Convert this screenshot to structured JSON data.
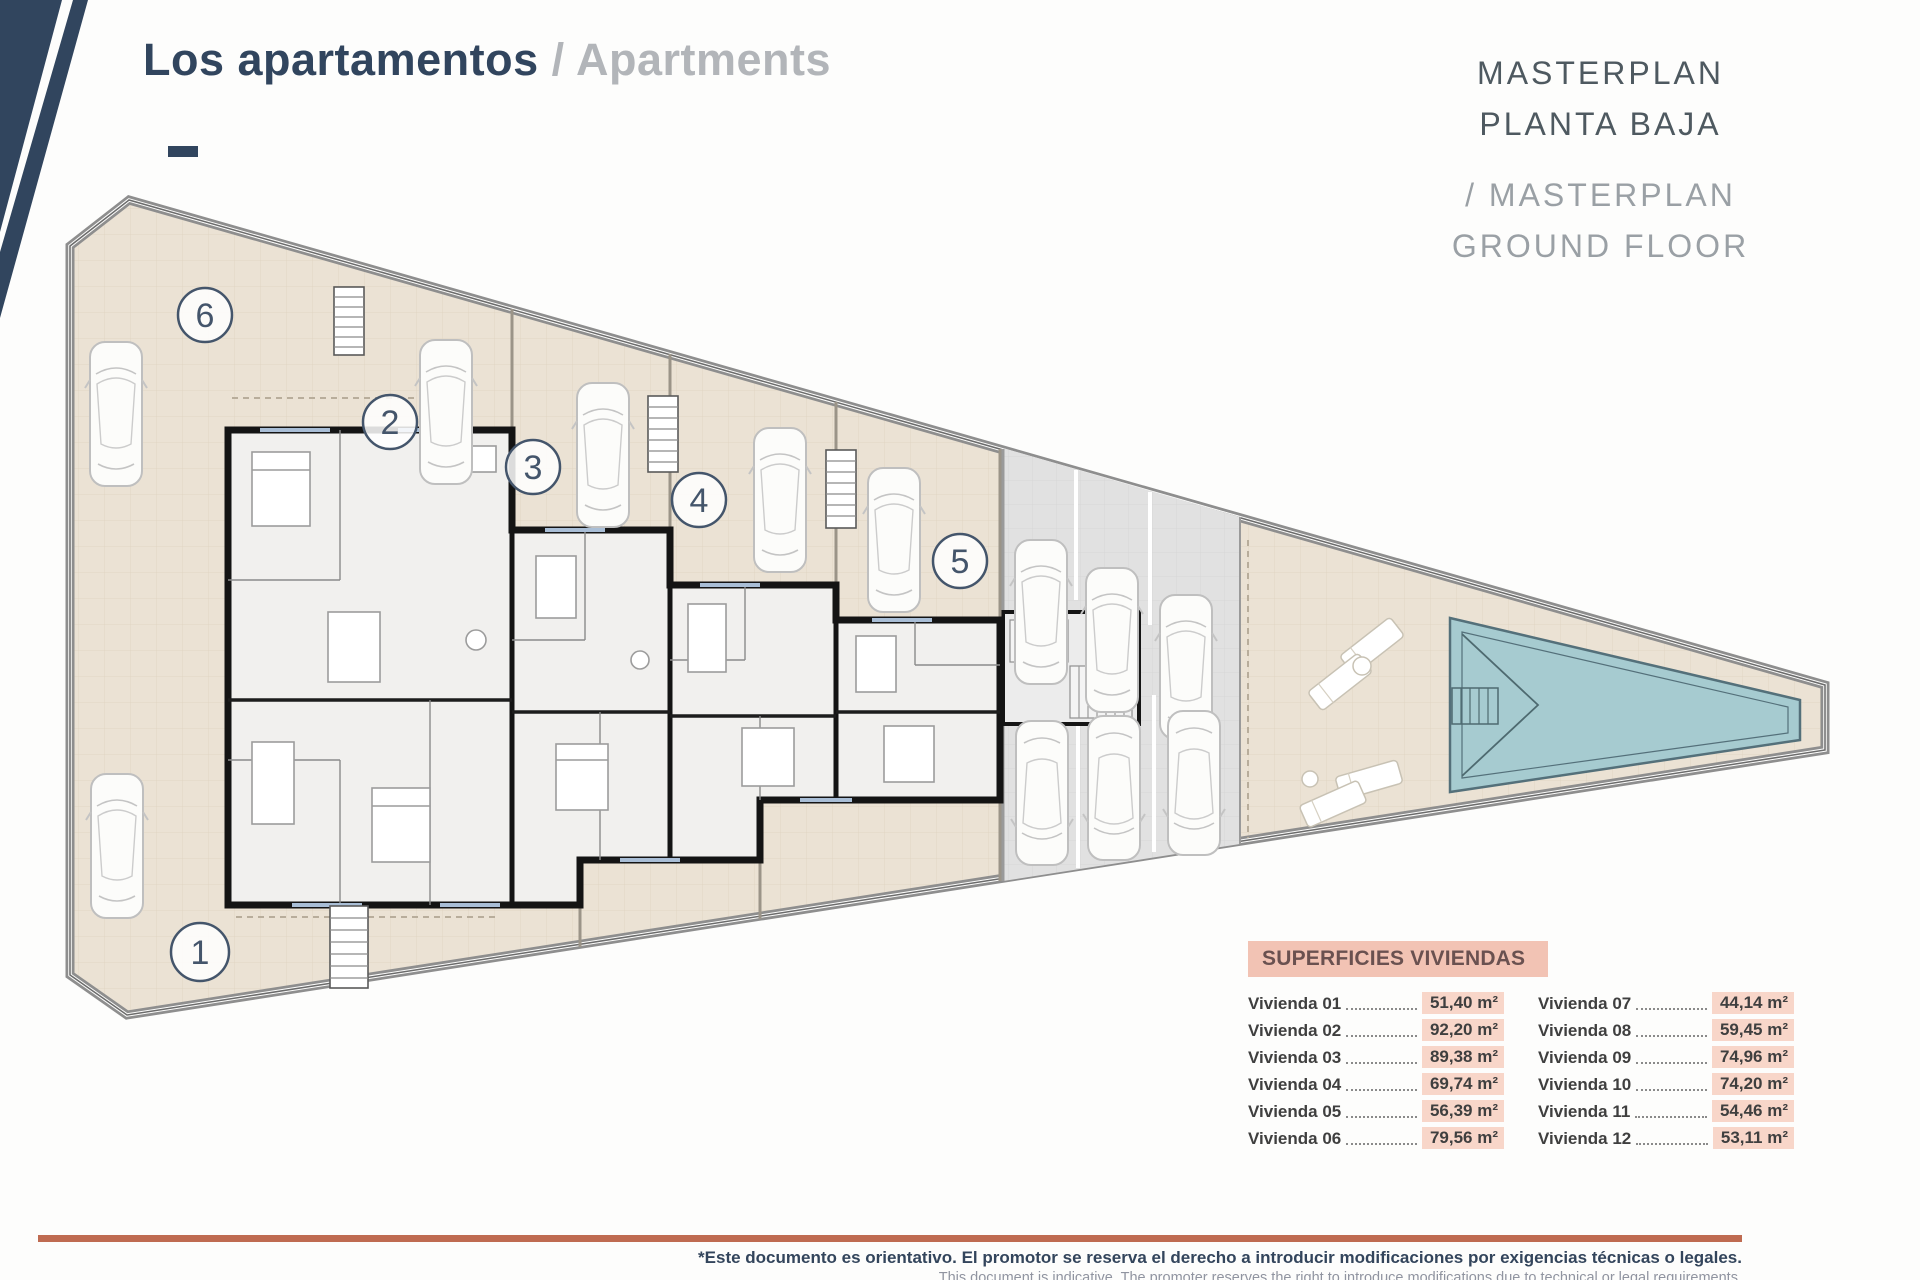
{
  "header": {
    "title_primary": "Los apartamentos",
    "title_separator": " / ",
    "title_secondary": "Apartments",
    "masterplan": {
      "line1": "MASTERPLAN",
      "line2": "PLANTA BAJA",
      "line3": "/ MASTERPLAN",
      "line4": "GROUND FLOOR"
    }
  },
  "plan": {
    "units": {
      "u1": "1",
      "u2": "2",
      "u3": "3",
      "u4": "4",
      "u5": "5",
      "u6": "6"
    }
  },
  "areas_table": {
    "title": "SUPERFICIES VIVIENDAS",
    "col1": [
      {
        "label": "Vivienda 01",
        "value": "51,40 m²"
      },
      {
        "label": "Vivienda 02",
        "value": "92,20 m²"
      },
      {
        "label": "Vivienda 03",
        "value": "89,38 m²"
      },
      {
        "label": "Vivienda 04",
        "value": "69,74 m²"
      },
      {
        "label": "Vivienda 05",
        "value": "56,39 m²"
      },
      {
        "label": "Vivienda 06",
        "value": "79,56 m²"
      }
    ],
    "col2": [
      {
        "label": "Vivienda 07",
        "value": "44,14 m²"
      },
      {
        "label": "Vivienda 08",
        "value": "59,45 m²"
      },
      {
        "label": "Vivienda 09",
        "value": "74,96 m²"
      },
      {
        "label": "Vivienda 10",
        "value": "74,20 m²"
      },
      {
        "label": "Vivienda 11",
        "value": "54,46 m²"
      },
      {
        "label": "Vivienda 12",
        "value": "53,11 m²"
      }
    ]
  },
  "footer": {
    "disclaimer_primary": "*Este documento es orientativo. El promotor se reserva el derecho a introducir modificaciones por exigencias técnicas o legales.",
    "disclaimer_secondary": "This document is indicative. The promoter reserves the right to introduce modifications due to technical or legal requirements."
  },
  "colors": {
    "accent_navy": "#31455e",
    "accent_terracotta": "#bf6b51",
    "table_header_bg": "#f2c3b4",
    "value_highlight_bg": "#f8d6c9",
    "plan_patio_beige": "#ebe2d4",
    "plan_parking_gray": "#e1e1e1",
    "pool_teal": "#a6cbd0",
    "wall_black": "#141414"
  }
}
